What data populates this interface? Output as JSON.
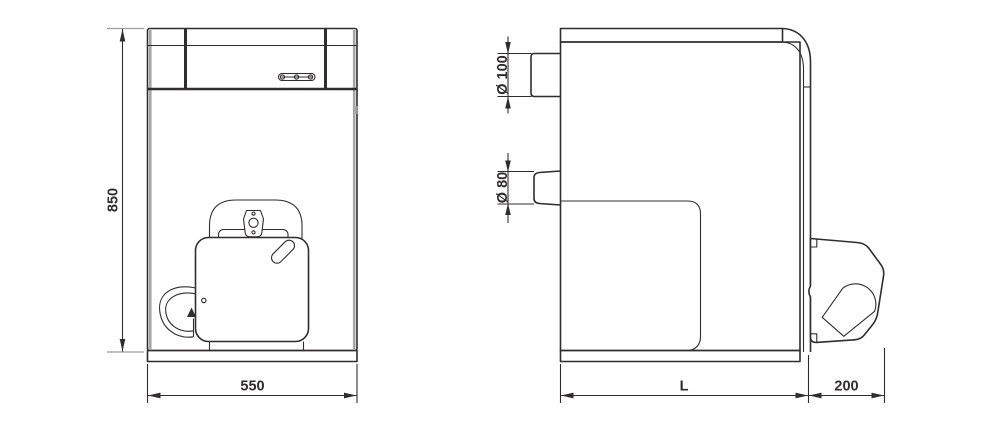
{
  "colors": {
    "line": "#312d2f",
    "shade": "#9c9c9c",
    "background": "#ffffff"
  },
  "front_view": {
    "labels": {
      "height": "850",
      "width": "550"
    }
  },
  "side_view": {
    "labels": {
      "flue": "Ø 100",
      "outlet": "Ø 80",
      "depth": "L",
      "burner": "200"
    }
  }
}
